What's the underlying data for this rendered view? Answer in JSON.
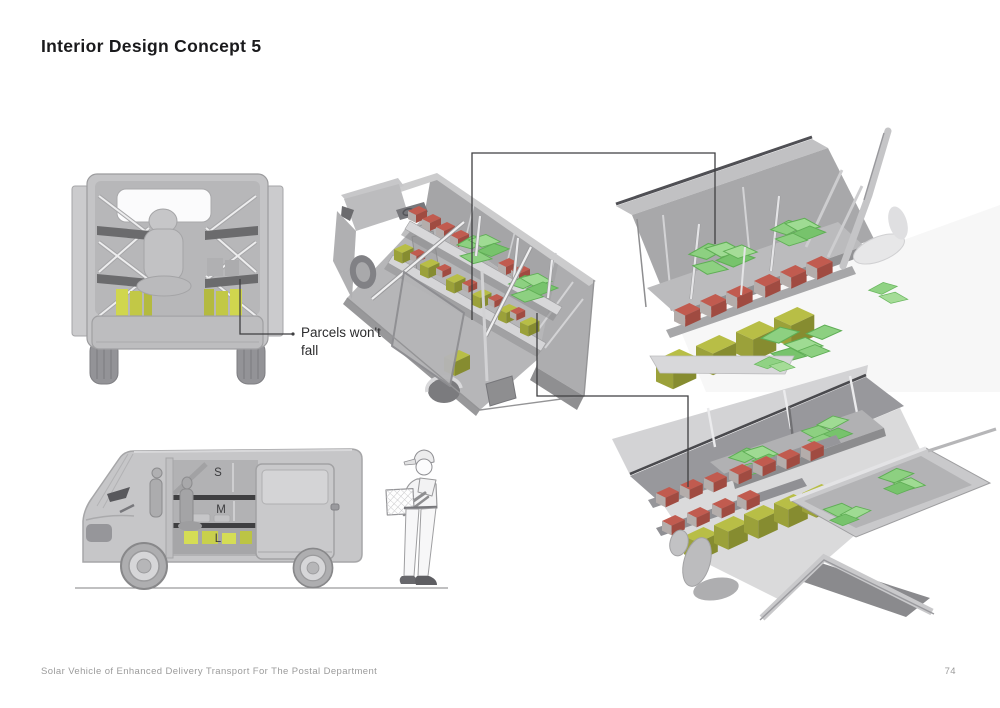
{
  "page": {
    "title": "Interior Design Concept 5",
    "footer": {
      "project": "Solar Vehicle of Enhanced Delivery Transport For The Postal Department",
      "page_number": "74"
    }
  },
  "annotations": {
    "parcels_note": "Parcels won't fall",
    "sizes": {
      "small": "S",
      "medium": "M",
      "large": "L"
    }
  },
  "colors": {
    "parcel_green": "#8dd081",
    "parcel_red": "#c15b4f",
    "parcel_yellow": "#c2c846",
    "vehicle_gray": "#c4c4c6",
    "callout_line": "#3f3f41",
    "title_text": "#1a1a1c",
    "footer_text": "#9b9b9b"
  }
}
